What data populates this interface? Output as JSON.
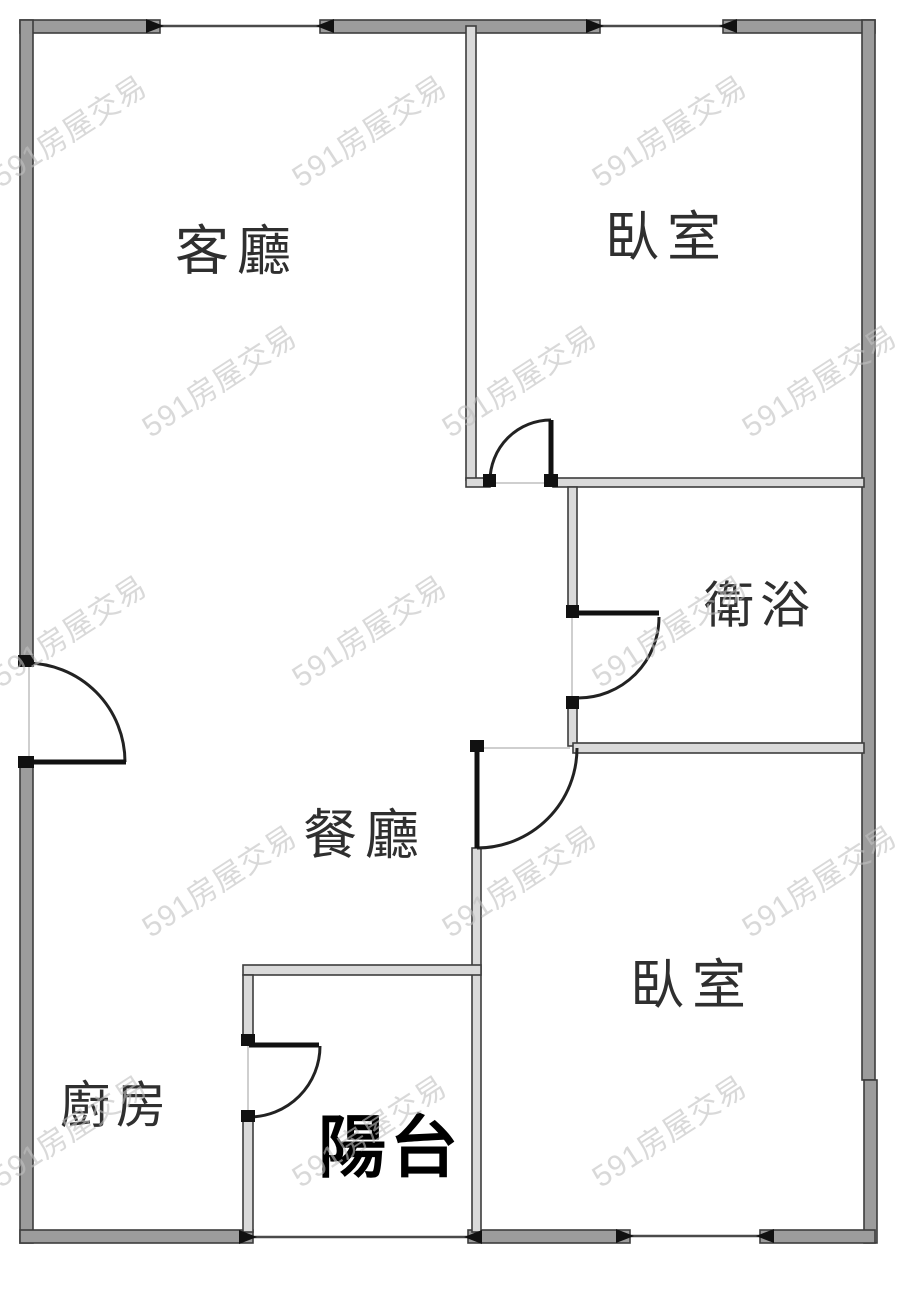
{
  "page": {
    "background": "#ffffff",
    "width": 900,
    "height": 1290
  },
  "watermark": {
    "text": "591房屋交易",
    "color": "#c1c1c1",
    "opacity": 0.6,
    "rotation_deg": -33,
    "font_size": 30,
    "positions": [
      [
        75,
        140
      ],
      [
        375,
        140
      ],
      [
        675,
        140
      ],
      [
        225,
        390
      ],
      [
        525,
        390
      ],
      [
        825,
        390
      ],
      [
        75,
        640
      ],
      [
        375,
        640
      ],
      [
        675,
        640
      ],
      [
        225,
        890
      ],
      [
        525,
        890
      ],
      [
        825,
        890
      ],
      [
        75,
        1140
      ],
      [
        375,
        1140
      ],
      [
        675,
        1140
      ]
    ]
  },
  "plan": {
    "colors": {
      "outer_wall_fill": "#9c9c9c",
      "inner_wall_fill": "#dadada",
      "wall_stroke": "#3d3d3d",
      "door": "#111111",
      "arc": "#222222",
      "window_line": "#4a4a4a",
      "arrow": "#111111",
      "threshold": "#cfcfcf",
      "label": "#2f2f2f",
      "balcony_label": "#000000"
    },
    "walls": [
      {
        "name": "top-wall-left",
        "x": 20,
        "y": 20,
        "w": 140,
        "h": 13,
        "t": "outer"
      },
      {
        "name": "top-wall-mid",
        "x": 320,
        "y": 20,
        "w": 280,
        "h": 13,
        "t": "outer"
      },
      {
        "name": "top-wall-right",
        "x": 723,
        "y": 20,
        "w": 152,
        "h": 13,
        "t": "outer"
      },
      {
        "name": "left-wall-upper",
        "x": 20,
        "y": 20,
        "w": 13,
        "h": 645,
        "t": "outer"
      },
      {
        "name": "left-wall-lower",
        "x": 20,
        "y": 762,
        "w": 13,
        "h": 481,
        "t": "outer"
      },
      {
        "name": "right-wall-upper",
        "x": 862,
        "y": 20,
        "w": 13,
        "h": 1060,
        "t": "outer"
      },
      {
        "name": "right-wall-lower",
        "x": 864,
        "y": 1080,
        "w": 13,
        "h": 163,
        "t": "outer"
      },
      {
        "name": "kitchen-bottom-wall",
        "x": 20,
        "y": 1230,
        "w": 233,
        "h": 13,
        "t": "outer"
      },
      {
        "name": "bedroom2-bottom-wall-left",
        "x": 468,
        "y": 1230,
        "w": 162,
        "h": 13,
        "t": "outer"
      },
      {
        "name": "bedroom2-bottom-wall-right",
        "x": 760,
        "y": 1230,
        "w": 115,
        "h": 13,
        "t": "outer"
      },
      {
        "name": "living-bedroom1-divider",
        "x": 466,
        "y": 26,
        "w": 10,
        "h": 454,
        "t": "inner"
      },
      {
        "name": "bedroom1-bottom-wall-stub",
        "x": 466,
        "y": 478,
        "w": 24,
        "h": 9,
        "t": "inner"
      },
      {
        "name": "bedroom1-bottom-wall",
        "x": 553,
        "y": 478,
        "w": 311,
        "h": 9,
        "t": "inner"
      },
      {
        "name": "bathroom-left-wall-upper",
        "x": 568,
        "y": 487,
        "w": 9,
        "h": 128,
        "t": "inner"
      },
      {
        "name": "bathroom-left-wall-lower",
        "x": 568,
        "y": 700,
        "w": 9,
        "h": 46,
        "t": "inner"
      },
      {
        "name": "hall-bedroom2-wall",
        "x": 573,
        "y": 743,
        "w": 291,
        "h": 10,
        "t": "inner"
      },
      {
        "name": "bedroom2-left-wall",
        "x": 472,
        "y": 848,
        "w": 9,
        "h": 384,
        "t": "inner"
      },
      {
        "name": "balcony-top-wall",
        "x": 243,
        "y": 965,
        "w": 238,
        "h": 10,
        "t": "inner"
      },
      {
        "name": "kitchen-balcony-wall-upper",
        "x": 243,
        "y": 975,
        "w": 10,
        "h": 68,
        "t": "inner"
      },
      {
        "name": "kitchen-balcony-wall-lower",
        "x": 243,
        "y": 1118,
        "w": 10,
        "h": 114,
        "t": "inner"
      }
    ],
    "windows": [
      {
        "name": "window-top-left",
        "x1": 160,
        "y": 26,
        "x2": 320
      },
      {
        "name": "window-top-right",
        "x1": 600,
        "y": 26,
        "x2": 723
      },
      {
        "name": "window-bedroom2-bottom",
        "x1": 630,
        "y": 1236,
        "x2": 760
      },
      {
        "name": "balcony-opening",
        "x1": 253,
        "y": 1237,
        "x2": 468
      }
    ],
    "doors": [
      {
        "name": "entry-door",
        "leaf": [
          26,
          762,
          126,
          762
        ],
        "arc": {
          "sx": 26,
          "sy": 663,
          "r": 99,
          "ex": 125,
          "ey": 762,
          "sweep": 1
        },
        "feet": [
          [
            18,
            655,
            16,
            12
          ],
          [
            18,
            756,
            16,
            12
          ]
        ]
      },
      {
        "name": "bedroom1-door",
        "leaf": [
          551,
          420,
          551,
          480
        ],
        "arc": {
          "sx": 551,
          "sy": 420,
          "r": 61,
          "ex": 490,
          "ey": 481,
          "sweep": 0
        },
        "feet": [
          [
            483,
            474,
            13,
            13
          ],
          [
            544,
            474,
            14,
            13
          ]
        ]
      },
      {
        "name": "bathroom-door",
        "leaf": [
          578,
          613,
          659,
          613
        ],
        "arc": {
          "sx": 659,
          "sy": 617,
          "r": 81,
          "ex": 578,
          "ey": 698,
          "sweep": 1
        },
        "feet": [
          [
            566,
            605,
            13,
            13
          ],
          [
            566,
            696,
            13,
            13
          ]
        ]
      },
      {
        "name": "bedroom2-hall-door",
        "leaf": [
          477,
          748,
          477,
          848
        ],
        "arc": {
          "sx": 477,
          "sy": 848,
          "r": 100,
          "ex": 577,
          "ey": 748,
          "sweep": 0
        },
        "feet": [
          [
            470,
            740,
            14,
            12
          ]
        ]
      },
      {
        "name": "kitchen-balcony-door",
        "leaf": [
          249,
          1045,
          319,
          1045
        ],
        "arc": {
          "sx": 320,
          "sy": 1046,
          "r": 71,
          "ex": 249,
          "ey": 1117,
          "sweep": 1
        },
        "feet": [
          [
            241,
            1034,
            14,
            12
          ],
          [
            241,
            1110,
            14,
            12
          ]
        ]
      }
    ],
    "thresholds": [
      {
        "name": "entry-door-threshold",
        "x1": 29,
        "y1": 665,
        "x2": 29,
        "y2": 760
      },
      {
        "name": "bedroom1-door-threshold",
        "x1": 492,
        "y1": 483,
        "x2": 549,
        "y2": 483
      },
      {
        "name": "bathroom-door-threshold",
        "x1": 572,
        "y1": 617,
        "x2": 572,
        "y2": 698
      },
      {
        "name": "bedroom2-door-threshold",
        "x1": 479,
        "y1": 748,
        "x2": 570,
        "y2": 748
      },
      {
        "name": "kitchen-door-threshold",
        "x1": 248,
        "y1": 1046,
        "x2": 248,
        "y2": 1116
      }
    ],
    "labels": [
      {
        "name": "living-room-label",
        "text": "客廳",
        "x": 237,
        "y": 257,
        "size": 54,
        "bold": false,
        "ls": 8
      },
      {
        "name": "bedroom1-label",
        "text": "臥室",
        "x": 667,
        "y": 243,
        "size": 54,
        "bold": false,
        "ls": 8
      },
      {
        "name": "bathroom-label",
        "text": "衛浴",
        "x": 760,
        "y": 611,
        "size": 50,
        "bold": false,
        "ls": 6
      },
      {
        "name": "dining-room-label",
        "text": "餐廳",
        "x": 365,
        "y": 841,
        "size": 54,
        "bold": false,
        "ls": 8
      },
      {
        "name": "bedroom2-label",
        "text": "臥室",
        "x": 692,
        "y": 991,
        "size": 54,
        "bold": false,
        "ls": 8
      },
      {
        "name": "kitchen-label",
        "text": "廚房",
        "x": 116,
        "y": 1111,
        "size": 50,
        "bold": false,
        "ls": 6
      },
      {
        "name": "balcony-label",
        "text": "陽台",
        "x": 390,
        "y": 1153,
        "size": 68,
        "bold": true,
        "ls": 4
      }
    ]
  }
}
